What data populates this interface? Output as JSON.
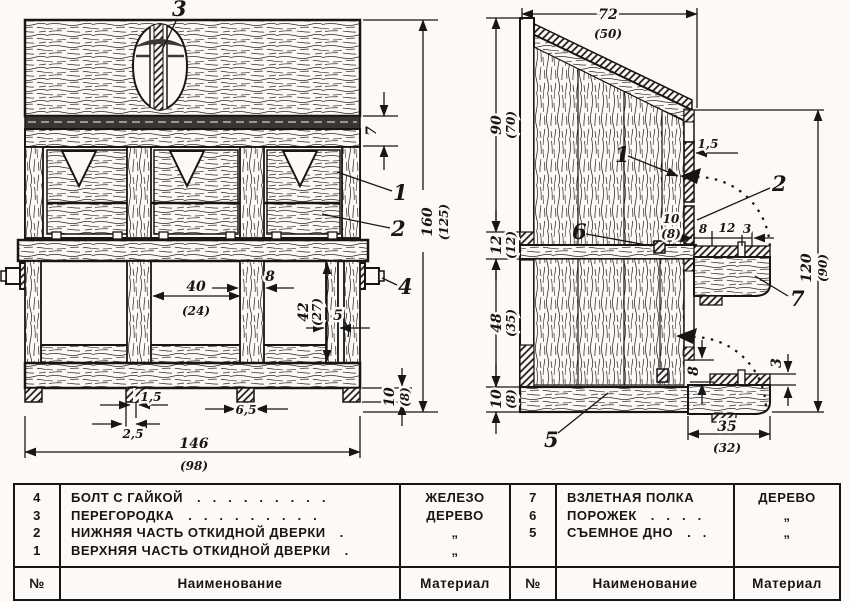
{
  "ink": "#161616",
  "paper": "#fdf9f6",
  "parts": {
    "n1": "1",
    "n2": "2",
    "n3": "3",
    "n4": "4",
    "n5": "5",
    "n6": "6",
    "n7": "7"
  },
  "front_view": {
    "dims": {
      "band": "7",
      "height": {
        "v": "160",
        "alt": "(125)"
      },
      "cell": {
        "v": "40",
        "alt": "(24)"
      },
      "post": "8",
      "lower": {
        "v": "42",
        "alt": "(27)"
      },
      "gap": "5",
      "slot": "1,5",
      "slot_off": "2,5",
      "foot": "6,5",
      "base": {
        "v": "10",
        "alt": "(8)"
      },
      "width": {
        "v": "146",
        "alt": "(98)"
      }
    }
  },
  "side_view": {
    "dims": {
      "top": {
        "v": "72",
        "alt": "(50)"
      },
      "upper": {
        "v": "90",
        "alt": "(70)"
      },
      "shelf": {
        "v": "12",
        "alt": "(12)"
      },
      "lower": {
        "v": "48",
        "alt": "(35)"
      },
      "base": {
        "v": "10",
        "alt": "(8)"
      },
      "wall": "1,5",
      "door": {
        "v": "10",
        "alt": "(8)"
      },
      "s8": "8",
      "s12": "12",
      "s3": "3",
      "right": {
        "v": "120",
        "alt": "(90)"
      },
      "bgap": "8",
      "blip": "3",
      "bshelf": {
        "v": "35",
        "alt": "(32)"
      }
    }
  },
  "tables": {
    "left": {
      "headers": {
        "num": "№",
        "name": "Наименование",
        "material": "Материал"
      },
      "rows": [
        {
          "num": "4",
          "name": "БОЛТ С ГАЙКОЙ",
          "dots": ".........",
          "material": "ЖЕЛЕЗО"
        },
        {
          "num": "3",
          "name": "ПЕРЕГОРОДКА",
          "dots": ".........",
          "material": "ДЕРЕВО"
        },
        {
          "num": "2",
          "name": "НИЖНЯЯ ЧАСТЬ ОТКИДНОЙ ДВЕРКИ",
          "dots": ".",
          "material": "„"
        },
        {
          "num": "1",
          "name": "ВЕРХНЯЯ ЧАСТЬ ОТКИДНОЙ ДВЕРКИ",
          "dots": ".",
          "material": "„"
        }
      ]
    },
    "right": {
      "headers": {
        "num": "№",
        "name": "Наименование",
        "material": "Материал"
      },
      "rows": [
        {
          "num": "7",
          "name": "ВЗЛЕТНАЯ ПОЛКА",
          "dots": "",
          "material": "ДЕРЕВО"
        },
        {
          "num": "6",
          "name": "ПОРОЖЕК",
          "dots": "....",
          "material": "„"
        },
        {
          "num": "5",
          "name": "СЪЕМНОЕ ДНО",
          "dots": "..",
          "material": "„"
        }
      ]
    }
  }
}
